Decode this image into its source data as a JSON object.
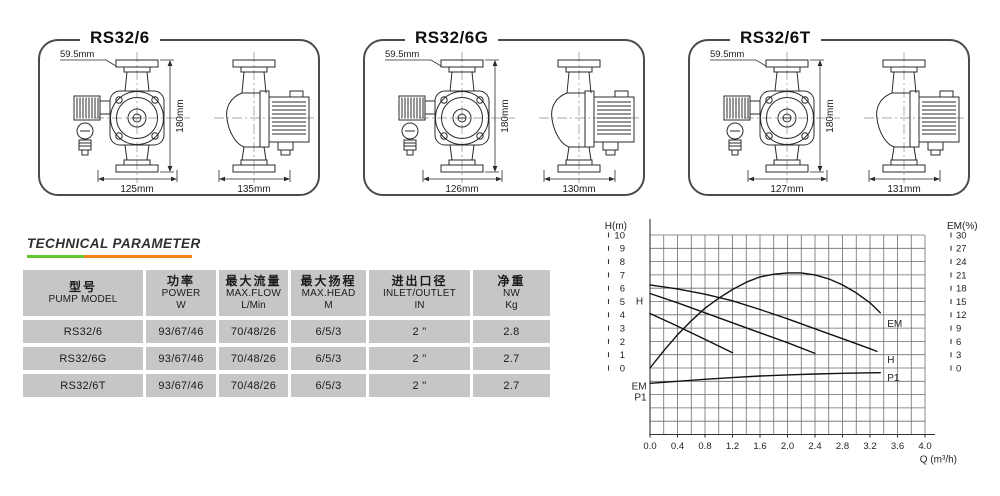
{
  "boxes": [
    {
      "title": "RS32/6",
      "dim_offset": "59.5mm",
      "dim_height": "180mm",
      "dim_front_width": "125mm",
      "dim_side_width": "135mm"
    },
    {
      "title": "RS32/6G",
      "dim_offset": "59.5mm",
      "dim_height": "180mm",
      "dim_front_width": "126mm",
      "dim_side_width": "130mm"
    },
    {
      "title": "RS32/6T",
      "dim_offset": "59.5mm",
      "dim_height": "180mm",
      "dim_front_width": "127mm",
      "dim_side_width": "131mm"
    }
  ],
  "section": {
    "heading": "TECHNICAL PARAMETER",
    "underline_green": "#66c42e",
    "underline_orange": "#f28418"
  },
  "table": {
    "headers": [
      {
        "zh": "型号",
        "en": "PUMP MODEL",
        "unit": ""
      },
      {
        "zh": "功率",
        "en": "POWER",
        "unit": "W"
      },
      {
        "zh": "最大流量",
        "en": "MAX.FLOW",
        "unit": "L/Min"
      },
      {
        "zh": "最大扬程",
        "en": "MAX.HEAD",
        "unit": "M"
      },
      {
        "zh": "进出口径",
        "en": "INLET/OUTLET",
        "unit": "IN"
      },
      {
        "zh": "净重",
        "en": "NW",
        "unit": "Kg"
      }
    ],
    "rows": [
      [
        "RS32/6",
        "93/67/46",
        "70/48/26",
        "6/5/3",
        "2 \"",
        "2.8"
      ],
      [
        "RS32/6G",
        "93/67/46",
        "70/48/26",
        "6/5/3",
        "2 \"",
        "2.7"
      ],
      [
        "RS32/6T",
        "93/67/46",
        "70/48/26",
        "6/5/3",
        "2 \"",
        "2.7"
      ]
    ]
  },
  "chart_data": {
    "type": "line",
    "title": "",
    "xlabel": "Q (m³/h)",
    "ylabel_left": "H(m)",
    "ylabel_right": "EM(%)",
    "x_range": [
      0.0,
      4.0
    ],
    "x_minor_step": 0.2,
    "x_tick_labels": [
      "0.0",
      "0.4",
      "0.8",
      "1.2",
      "1.6",
      "2.0",
      "2.4",
      "2.8",
      "3.2",
      "3.6",
      "4.0"
    ],
    "left_axis": {
      "label": "H(m)",
      "ticks": [
        10,
        9,
        8,
        7,
        6,
        5,
        4,
        3,
        2,
        1,
        0
      ]
    },
    "right_axis": {
      "label": "EM(%)",
      "ticks": [
        30,
        27,
        24,
        21,
        18,
        15,
        12,
        9,
        6,
        3,
        0
      ]
    },
    "grid": {
      "on": true,
      "rows_above_zero": 10,
      "rows_below_zero": 5
    },
    "legend_position": "inline-labels",
    "series": [
      {
        "name": "H-speed3",
        "axis": "left",
        "x": [
          0,
          0.4,
          0.8,
          1.2,
          1.6,
          2.0,
          2.4,
          2.8,
          3.2,
          3.3
        ],
        "y": [
          6.25,
          5.95,
          5.55,
          5.05,
          4.4,
          3.7,
          2.95,
          2.2,
          1.45,
          1.25
        ]
      },
      {
        "name": "H-speed2",
        "axis": "left",
        "x": [
          0,
          0.4,
          0.8,
          1.2,
          1.6,
          2.0,
          2.4
        ],
        "y": [
          5.6,
          4.9,
          4.15,
          3.4,
          2.65,
          1.9,
          1.1
        ]
      },
      {
        "name": "H-speed1",
        "axis": "left",
        "x": [
          0,
          0.4,
          0.8,
          1.2
        ],
        "y": [
          4.1,
          3.15,
          2.15,
          1.15
        ]
      },
      {
        "name": "EM",
        "axis": "right",
        "x": [
          0,
          0.2,
          0.4,
          0.6,
          0.8,
          1.0,
          1.2,
          1.4,
          1.6,
          1.8,
          2.0,
          2.2,
          2.4,
          2.6,
          2.8,
          3.0,
          3.2,
          3.35
        ],
        "y": [
          0,
          1.3,
          2.5,
          3.55,
          4.5,
          5.25,
          5.9,
          6.45,
          6.85,
          7.05,
          7.15,
          7.15,
          7.0,
          6.7,
          6.25,
          5.65,
          4.9,
          4.15
        ],
        "percent": [
          0,
          3.9,
          7.5,
          10.7,
          13.5,
          15.8,
          17.7,
          19.4,
          20.6,
          21.2,
          21.5,
          21.5,
          21.0,
          20.1,
          18.8,
          17.0,
          14.7,
          12.5
        ]
      },
      {
        "name": "P1",
        "axis": "unlabeled-power-axis",
        "x": [
          0,
          0.4,
          0.8,
          1.2,
          1.6,
          2.0,
          2.4,
          2.8,
          3.2,
          3.35
        ],
        "y": [
          -1.15,
          -1.0,
          -0.85,
          -0.72,
          -0.6,
          -0.52,
          -0.45,
          -0.4,
          -0.36,
          -0.35
        ]
      }
    ],
    "annotations": [
      {
        "text": "H",
        "q": -0.1,
        "h": 5.0,
        "anchor": "end"
      },
      {
        "text": "EM",
        "q": -0.05,
        "h": -1.4,
        "anchor": "end"
      },
      {
        "text": "P1",
        "q": -0.05,
        "h": -2.2,
        "anchor": "end"
      },
      {
        "text": "EM",
        "q": 3.45,
        "h": 3.3,
        "anchor": "start"
      },
      {
        "text": "H",
        "q": 3.45,
        "h": 0.6,
        "anchor": "start"
      },
      {
        "text": "P1",
        "q": 3.45,
        "h": -0.75,
        "anchor": "start"
      }
    ]
  }
}
